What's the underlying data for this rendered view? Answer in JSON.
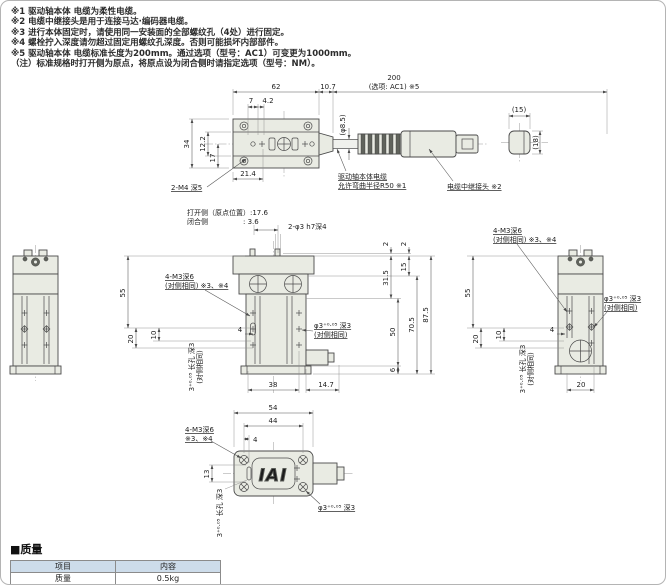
{
  "notes": {
    "line1": "※1 驱动轴本体 电缆为柔性电缆。",
    "line2": "※2 电缆中继接头是用于连接马达·编码器电缆。",
    "line3": "※3 进行本体固定时，请使用同一安装面的全部螺纹孔（4处）进行固定。",
    "line4": "※4 螺栓拧入深度请勿超过固定用螺纹孔深度。否则可能损坏内部部件。",
    "line5": "※5 驱动轴本体 电缆标准长度为200mm。通过选项（型号：AC1）可变更为1000mm。",
    "line6": "（注）标准规格时打开侧为原点，将原点设为闭合侧时请指定选项（型号：NM）。"
  },
  "top": {
    "d62": "62",
    "d107": "10.7",
    "d200": "200",
    "d200b": "(选项: AC1) ※5",
    "d7": "7",
    "d42": "4.2",
    "d34": "34",
    "d122": "12.2",
    "d17": "17",
    "d214": "21.4",
    "tap": "2-M4 深5",
    "dia": "(φ8.5)",
    "cable1": "驱动轴本体电缆",
    "cable2": "允许弯曲半径R50 ※1",
    "conn": "电缆中继接头 ※2",
    "cw": "(15)",
    "ch": "(18)"
  },
  "front": {
    "open": "打开侧（原点位置）:17.6",
    "close": "闭合侧　　　　　:  3.6",
    "pin": "2-φ3 h7深4",
    "d2": "2",
    "d315": "31.5",
    "d15": "15",
    "d50": "50",
    "d6": "6",
    "d705": "70.5",
    "d875": "87.5",
    "d38": "38",
    "d147": "14.7",
    "d55": "55",
    "d20": "20",
    "d10": "10",
    "d4": "4",
    "tap1": "4-M3深6",
    "tap2": "(对侧相同) ※3、※4",
    "slot1": "3⁺⁰·⁰⁵ 长孔 深3",
    "slot2": "(对侧相同)",
    "hole1": "φ3⁺⁰·⁰⁵ 深3",
    "hole2": "(对侧相同)"
  },
  "right": {
    "tap1": "4-M3深6",
    "tap2": "(对侧相同) ※3、※4",
    "hole1": "φ3⁺⁰·⁰⁵ 深3",
    "hole2": "(对侧相同)",
    "slot1": "3⁺⁰·⁰⁵ 长孔 深3",
    "slot2": "(对侧相同)",
    "d55": "55",
    "d20": "20",
    "d10": "10",
    "d4": "4",
    "d20b": "20"
  },
  "bottom": {
    "d54": "54",
    "d44": "44",
    "d4": "4",
    "d13": "13",
    "tap1": "4-M3深6",
    "tap2": "※3、※4",
    "slot": "3⁺⁰·⁰⁵ 长孔 深3",
    "hole": "φ3⁺⁰·⁰⁵ 深3",
    "logo": "IAI"
  },
  "table": {
    "heading": "■质量",
    "col1": "项目",
    "col2": "内容",
    "r1c1": "质量",
    "r1c2": "0.5kg"
  },
  "colors": {
    "body_fill": "#e9ebe3",
    "line": "#4a4a4a",
    "table_header": "#cddcea"
  }
}
